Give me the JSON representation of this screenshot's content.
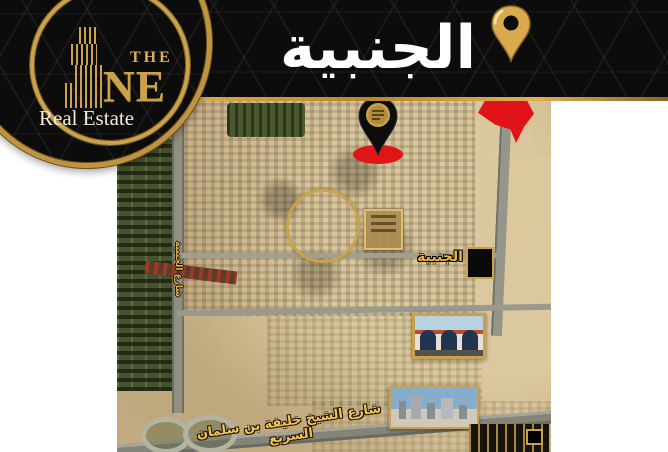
{
  "header": {
    "title": "الجنبية",
    "bg_color": "#0c0c0c",
    "accent_gold": "#c9a24b",
    "pin_icon": "gold-location-pin"
  },
  "logo": {
    "word_the": "THE",
    "word_ne": "NE",
    "tagline": "Real Estate",
    "icon": "gold-skyscraper-bars",
    "gold": "#c9a24b"
  },
  "map": {
    "type": "satellite",
    "area_label": "الجنبية",
    "main_street_label": "شارع الشيخ خليفة بن سلمان السريع",
    "side_street_label": "شارع الجنبية",
    "markers": {
      "company_pin": "black-map-pin-with-gold-logo",
      "red_area": "red-highlight-area",
      "gold_circle": "gold-circle-highlight",
      "plot_box": "gold-framed-plot-info-box",
      "black_square": "black-landmark-square"
    },
    "colors": {
      "sand": "#c9b189",
      "farm_green": "#47532e",
      "road_grey": "#8f8f82",
      "marker_red": "#e21318",
      "label_gold": "#eab346"
    }
  }
}
